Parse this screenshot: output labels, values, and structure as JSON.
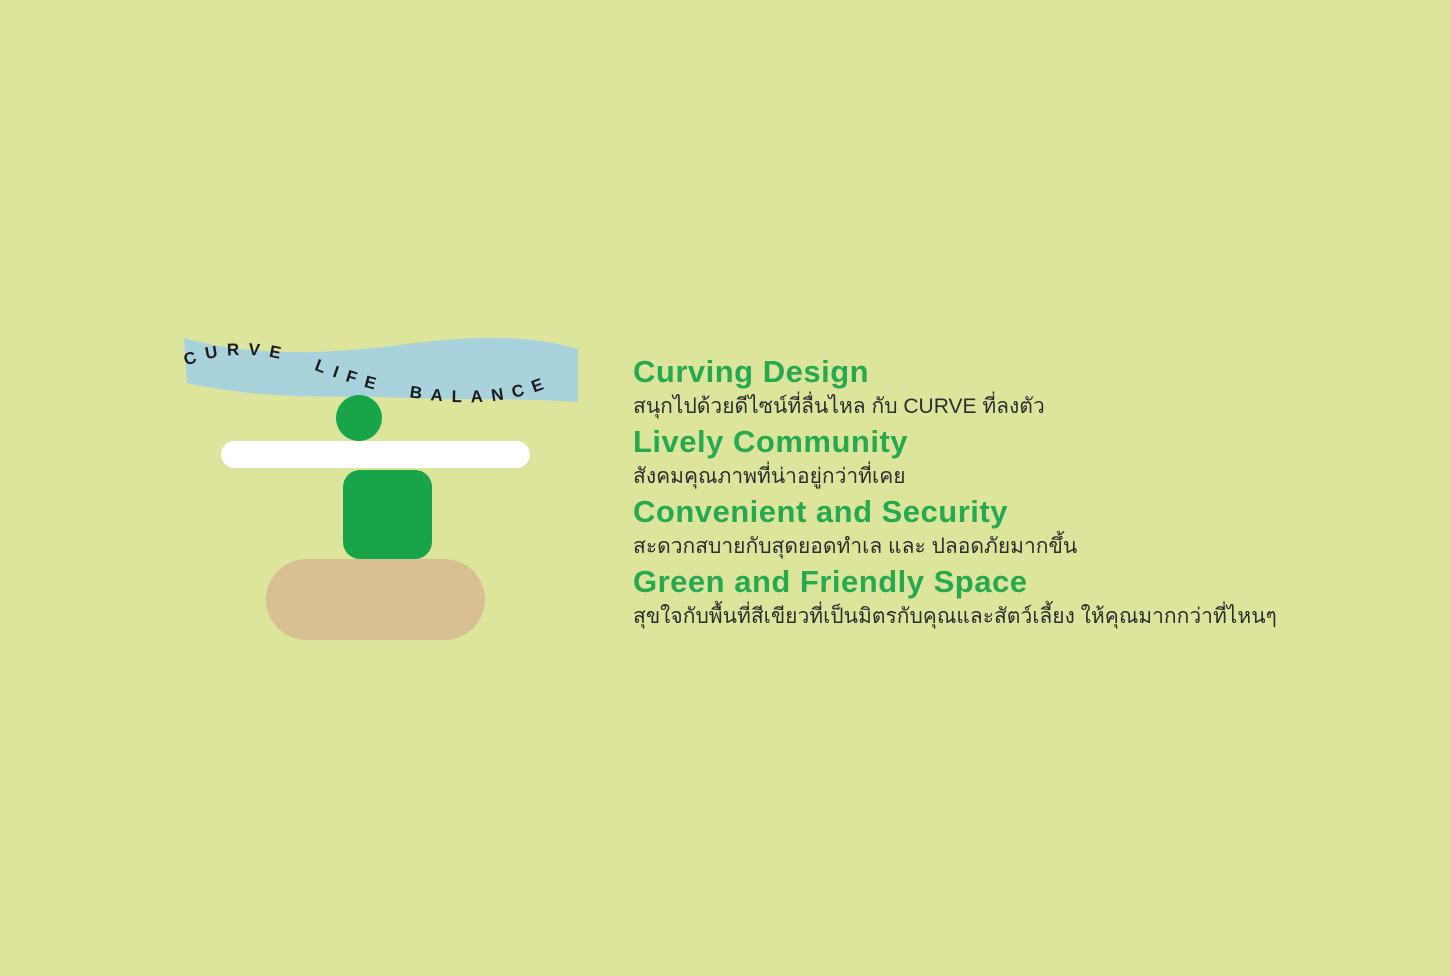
{
  "canvas": {
    "width": 1450,
    "height": 976,
    "background_color": "#dde59d"
  },
  "ribbon": {
    "text": "CURVE LIFE BALANCE",
    "band_color": "#a9d3dc",
    "text_color": "#1c1c1c"
  },
  "figure": {
    "head_color": "#18a54a",
    "bar_color": "#ffffff",
    "body_color": "#18a54a",
    "base_color": "#d9c092"
  },
  "colors": {
    "heading_green": "#27a94f",
    "subtitle_dark": "#2d2d2d"
  },
  "features": [
    {
      "title": "Curving Design",
      "subtitle": "สนุกไปด้วยดีไซน์ที่ลื่นไหล กับ CURVE ที่ลงตัว"
    },
    {
      "title": "Lively Community",
      "subtitle": "สังคมคุณภาพที่น่าอยู่กว่าที่เคย"
    },
    {
      "title": "Convenient and Security",
      "subtitle": "สะดวกสบายกับสุดยอดทำเล และ ปลอดภัยมากขึ้น"
    },
    {
      "title": "Green and Friendly Space",
      "subtitle": "สุขใจกับพื้นที่สีเขียวที่เป็นมิตรกับคุณและสัตว์เลี้ยง ให้คุณมากกว่าที่ไหนๆ"
    }
  ]
}
